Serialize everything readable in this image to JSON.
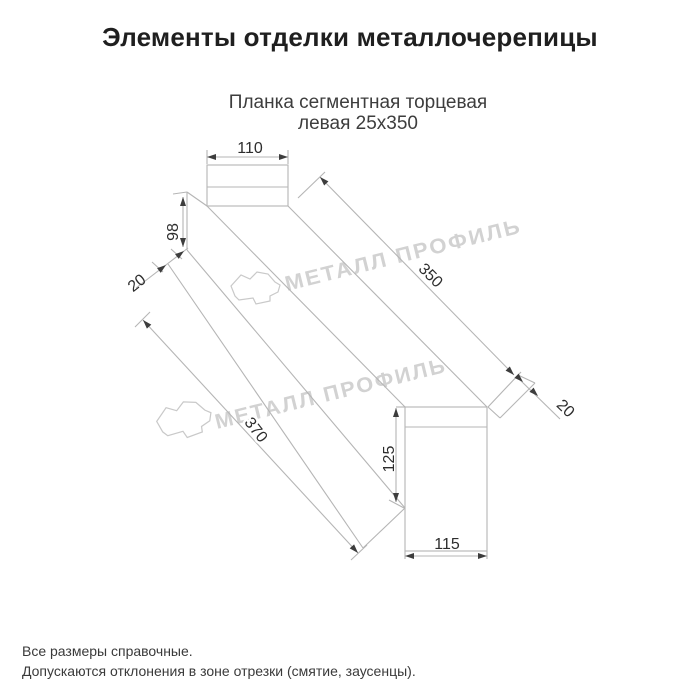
{
  "page": {
    "title": "Элементы отделки металлочерепицы"
  },
  "product": {
    "subtitle_line1": "Планка сегментная торцевая",
    "subtitle_line2": "левая 25х350"
  },
  "drawing": {
    "type": "technical-drawing",
    "dimensions": {
      "top_flange_width": "110",
      "left_end_height": "98",
      "left_hem_width": "20",
      "top_edge_length": "350",
      "right_hem_width": "20",
      "bottom_edge_length": "370",
      "right_end_height": "125",
      "right_end_width": "115"
    }
  },
  "watermark": {
    "text": "МЕТАЛЛ ПРОФИЛЬ",
    "icon": "cloud-logo"
  },
  "footer": {
    "note1": "Все размеры справочные.",
    "note2": "Допускаются отклонения в зоне отрезки (смятие, заусенцы)."
  },
  "colors": {
    "line": "#b5b5b5",
    "arrow": "#3d3d3d",
    "dim_text": "#2d2d2d",
    "watermark": "#d2d2d2",
    "title_text": "#1f1f1f",
    "body_text": "#3a3a3a"
  }
}
